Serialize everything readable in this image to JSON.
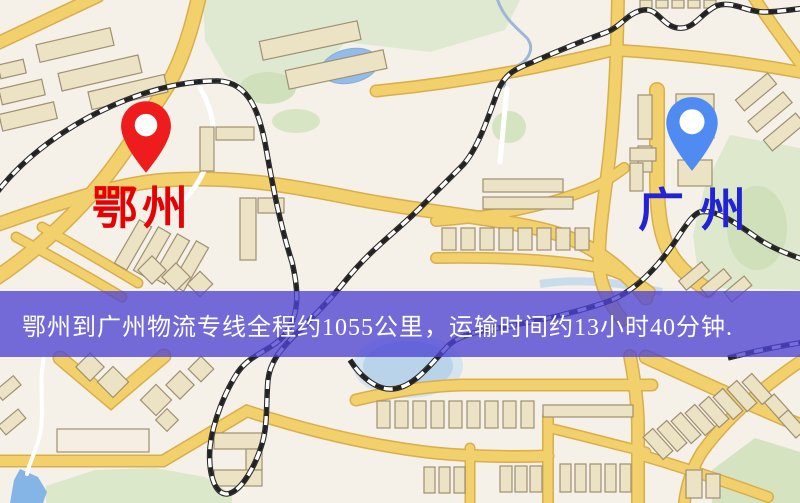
{
  "map": {
    "type": "road-map",
    "origin_marker": {
      "name": "鄂州",
      "pin_color": "#ee1c1c",
      "label_color": "#e60202"
    },
    "destination_marker": {
      "name": "广州",
      "pin_color": "#4f8bf0",
      "label_color": "#2323d6"
    },
    "banner": {
      "text": "鄂州到广州物流专线全程约1055公里，运输时间约13小时40分钟.",
      "bg_color": "#4e44d4",
      "text_color": "#ffffff"
    },
    "route": {
      "origin": "鄂州",
      "destination": "广州",
      "distance_km": "1055",
      "duration": "13小时40分钟"
    },
    "palette": {
      "background": "#f5f1e8",
      "road_fill": "#f2d06b",
      "road_casing": "#d9ae4c",
      "park": "#dde8cc",
      "water": "#8fb9e8",
      "building_fill": "#ece2c4",
      "building_stroke": "#a09072",
      "railway": "#222222"
    }
  }
}
